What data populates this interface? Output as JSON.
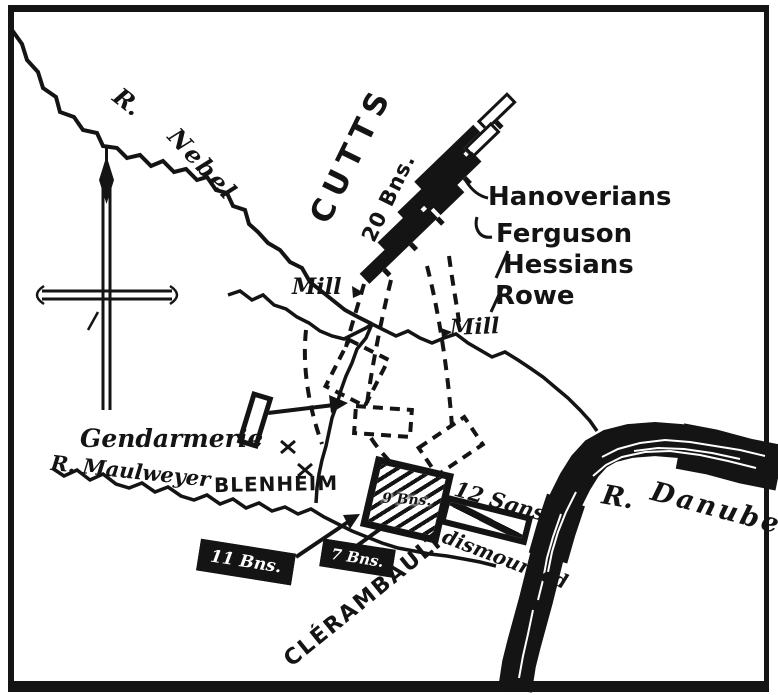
{
  "colors": {
    "ink": "#141414",
    "paper": "#ffffff"
  },
  "rivers": {
    "nebel_abbr": "R.",
    "nebel_name": "Nebel",
    "maulweyer": "R. Maulweyer",
    "danube_abbr": "R.",
    "danube_name": "Danube"
  },
  "places": {
    "blenheim": "BLENHEIM",
    "mill_west": "Mill",
    "mill_east": "Mill"
  },
  "allied": {
    "commander": "CUTTS",
    "strength": "20 Bns.",
    "brigades": [
      "Hanoverians",
      "Ferguson",
      "Hessians",
      "Rowe"
    ]
  },
  "french": {
    "commander": "CLÉRAMBAULT",
    "gendarmerie": "Gendarmerie",
    "garrison": "9 Bns.",
    "reinforcements": [
      "11 Bns.",
      "7 Bns."
    ],
    "cavalry": "12 Sqns.",
    "cavalry_note": "dismounted"
  },
  "icons": {
    "compass": "compass-rose-north-arrow",
    "mill_marker": "mill-triangle-marker",
    "skirmish": "crossed-strokes-mark"
  }
}
